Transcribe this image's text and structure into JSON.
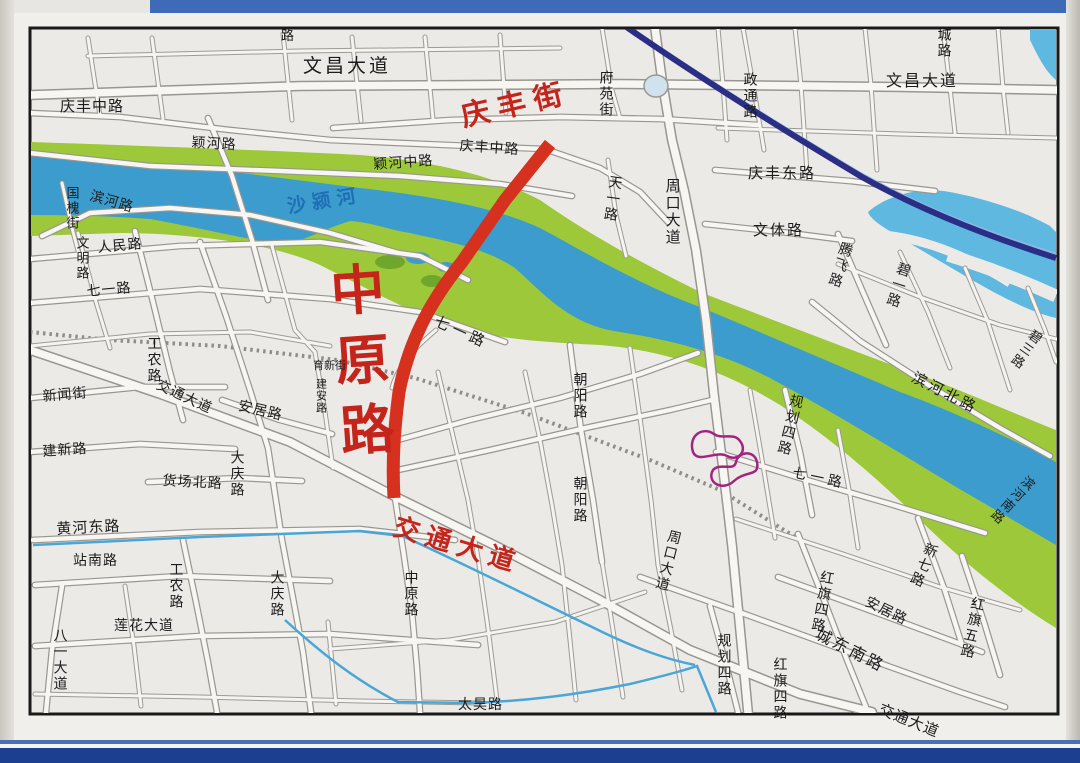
{
  "map_type": "city-street-map-photo",
  "colors": {
    "highlight_road_red": "#d6301f",
    "river_blue": "#3b9ccd",
    "river_bank_green": "#9cc83a",
    "lake_blue": "#5fb8e0",
    "railway_navy": "#2b2e85",
    "stream_blue": "#4aa6d6",
    "interchange_purple": "#a3247f",
    "frame_blue": "#1d3f8f",
    "map_background": "#eceae7"
  },
  "labels": {
    "qingfeng_street": "庆丰街",
    "zhongyuan_road_big": "中原路",
    "jiaotong_avenue_red": "交通大道",
    "shayinghe": "沙颍河",
    "wenchang_avenue_w": "文昌大道",
    "wenchang_avenue_e": "文昌大道",
    "qingfeng_mid_w": "庆丰中路",
    "qingfeng_mid_c": "庆丰中路",
    "yinghe_road": "颖河路",
    "yinghe_mid_road": "颖河中路",
    "binhe_road": "滨河路",
    "guohuai_street": "国槐街",
    "wenming_road": "文明路",
    "renmin_road": "人民路",
    "qiyi_road_w": "七一路",
    "gongnong_road_n": "工农路",
    "xinwen_street": "新闻街",
    "jiaotong_avenue_black": "交通大道",
    "anju_road_w": "安居路",
    "jianxin_road": "建新路",
    "huochang_north_road": "货场北路",
    "daqing_road_n": "大庆路",
    "yuxin_street": "育新街",
    "jianan_road": "建安路",
    "qiyi_road_c": "七一路",
    "chaoyang_road_n": "朝阳路",
    "chaoyang_road_s": "朝阳路",
    "fuyuan_street": "府苑街",
    "tianyi_road": "天一路",
    "zhoukou_avenue_n": "周口大道",
    "zhoukou_avenue_s": "周口大道",
    "wenti_road": "文体路",
    "qingfeng_east_road": "庆丰东路",
    "zhengtong_road": "政通路",
    "cheng_road": "城路",
    "tengfei_road": "腾飞路",
    "biyi_road": "碧一路",
    "bisan_road": "碧三路",
    "binhe_north_road": "滨河北路",
    "binhe_south_road": "滨河南路",
    "guihua_4_road_e": "规划四路",
    "qiyi_road_e": "七一路",
    "huanghe_east_road": "黄河东路",
    "zhannan_road": "站南路",
    "gongnong_road_s": "工农路",
    "daqing_road_s": "大庆路",
    "lianhua_avenue": "莲花大道",
    "bayi_avenue": "八一大道",
    "zhongyuan_road_s": "中原路",
    "taihao_road": "太昊路",
    "guihua_4_road_s": "规划四路",
    "hongqi_4_road_n": "红旗四路",
    "anju_road_e": "安居路",
    "chengdongnan_road": "城东南路",
    "xinqi_road": "新七路",
    "hongqi_5_road": "红旗五路",
    "hongqi_4_road_s": "红旗四路",
    "jiaotong_avenue_se": "交通大道",
    "top_edge_partial": "路"
  }
}
